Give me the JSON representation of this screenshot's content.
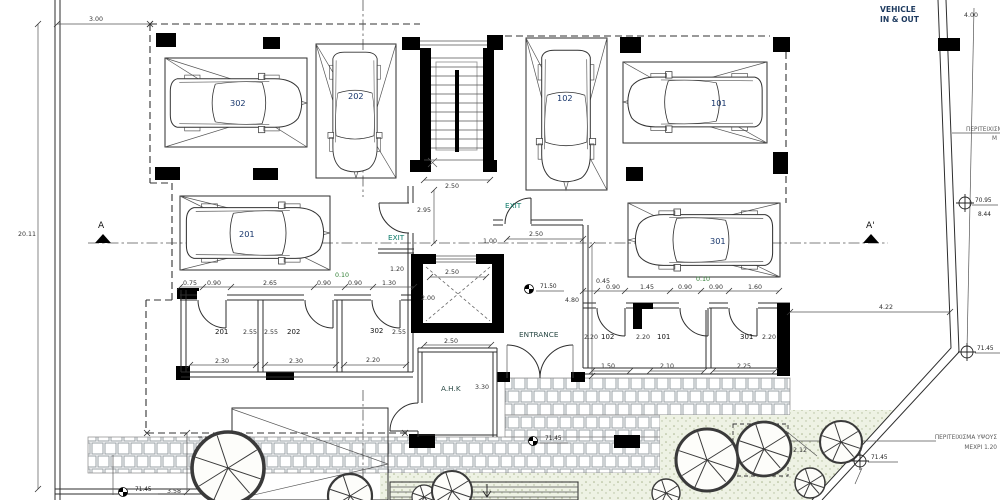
{
  "labels": {
    "vehicle1": "VEHICLE",
    "vehicle2": "IN & OUT",
    "exit_left": "EXIT",
    "exit_top": "EXIT",
    "entrance": "ENTRANCE",
    "ahk": "A.H.K",
    "section_a": "A",
    "section_a_prime": "A'",
    "perimeter_right1": "ΠΕΡΙΤΕΙΧΙΣΜ",
    "perimeter_right2": "Μ",
    "perimeter_br1": "ΠΕΡΙΤΕΙΧΙΣΜΑ ΥΨΟΥΣ",
    "perimeter_br2": "ΜΕΧΡΙ 1.20",
    "wheelchair_icon": "♿"
  },
  "cars": {
    "p302": "302",
    "p202": "202",
    "p102": "102",
    "p101": "101",
    "p201": "201",
    "p301": "301"
  },
  "rooms_left": {
    "n201": "201",
    "n202": "202",
    "n302": "302",
    "d255a": "2.55",
    "d255b": "2.55",
    "d255c": "2.55",
    "w201": "2.30",
    "w202": "2.30",
    "w302": "2.20"
  },
  "rooms_right": {
    "n102": "102",
    "n101": "101",
    "n301": "301",
    "d220a": "2.20",
    "d220b": "2.20",
    "d220c": "2.20",
    "w102": "1.50",
    "w101": "2.10",
    "w301": "2.25"
  },
  "strip_left": [
    "0.75",
    "0.90",
    "2.65",
    "0.90",
    "0.10",
    "0.90",
    "1.30"
  ],
  "strip_right": [
    "0.45",
    "0.90",
    "1.45",
    "0.90",
    "0.10",
    "0.90",
    "1.60"
  ],
  "dims": {
    "plot_height": "20.11",
    "front_setback": "3.00",
    "driveway": "4.00",
    "stair_w": "2.50",
    "stair_lobby": "2.95",
    "corridor_top": "2.50",
    "door": "1.00",
    "elev_w": "2.50",
    "elev_d": "2.00",
    "ahk_w": "2.50",
    "ahk_h": "3.30",
    "corridor_len": "4.80",
    "side_setback": "4.22",
    "wall_offset": "2.12",
    "ramp_w": "3.58",
    "exit_jamb": "1.20"
  },
  "levels": {
    "entry": "71.50",
    "walkway": "71.45",
    "bottom_left": "71.45",
    "garden": "71.45",
    "right_edge": "71.45",
    "bench_top": "70.95",
    "bench_bottom": "8.44"
  }
}
